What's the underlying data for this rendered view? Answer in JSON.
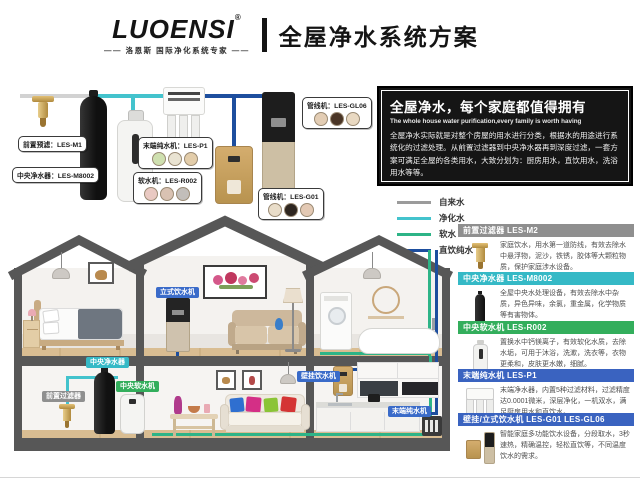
{
  "header": {
    "logo": "LUOENSI",
    "logo_reg": "®",
    "tagline": "—— 洛恩斯 国际净化系统专家 ——",
    "title": "全屋净水系统方案"
  },
  "intro_box": {
    "title": "全屋净水，每个家庭都值得拥有",
    "subtitle": "The whole house water purification,every family is worth having",
    "body": "全屋净水实际就是对整个房屋的用水进行分类，根据水的用途进行系统化的过滤处理。从前置过滤器到中央净水器再到深度过滤，一套方案可满足全屋的各类用水，大致分划为：厨房用水，直饮用水，洗浴用水等等。"
  },
  "legend": {
    "items": [
      {
        "label": "自来水",
        "color": "#9b9b9b"
      },
      {
        "label": "净化水",
        "color": "#43c3cd"
      },
      {
        "label": "软水",
        "color": "#2db487"
      },
      {
        "label": "直饮纯水",
        "color": "#1d4e9e"
      }
    ]
  },
  "top_diagram": {
    "callouts": {
      "prefilter": "前置预滤：LES-M1",
      "central_purifier": "中央净水器：LES-M8002",
      "terminal_purifier": "末端纯水机：LES-P1",
      "softener": "软水机：LES-R002",
      "pipeline_stand": "管线机：LES-GL06",
      "pipeline_wall": "管线机：LES-G01"
    }
  },
  "house": {
    "labels": {
      "stand_dispenser": "立式饮水机",
      "central_purifier": "中央净水器",
      "prefilter": "前置过滤器",
      "central_softener": "中央软水机",
      "wall_dispenser": "壁挂饮水机",
      "terminal_purifier": "末端纯水机"
    }
  },
  "product_panels": [
    {
      "title": "前置过滤器 LES-M2",
      "header_color": "#8f8f8f",
      "desc": "家庭饮水，用水第一道防线，有效去除水中悬浮物，泥沙，铁锈，胶体等大颗粒物质，保护家庭涉水设备。"
    },
    {
      "title": "中央净水器 LES-M8002",
      "header_color": "#35b9c6",
      "desc": "全屋中央水处理设备，有效去除水中杂质，异色异味，余氯，重金属，化学物质等有害物体。"
    },
    {
      "title": "中央软水机 LES-R002",
      "header_color": "#33ae5c",
      "desc": "置换水中钙镁离子，有效软化水质，去除水垢，可用于沐浴，洗漱，洗衣等，衣物更柔和，皮肤更水嫩，细腻。"
    },
    {
      "title": "末端纯水机 LES-P1",
      "header_color": "#3a63c0",
      "desc": "末端净水器，内置5种过滤材料，过滤精度达0.0001微米，深层净化，一机双水，满足厨房用水和直饮水。"
    },
    {
      "title": "壁挂/立式饮水机 LES-G01  LES-GL06",
      "header_color": "#3a63c0",
      "desc": "智能家庭多功能饮水设备，分段取水，3秒速热，精确温控，轻松直饮等，不同温度饮水的需求。"
    }
  ]
}
